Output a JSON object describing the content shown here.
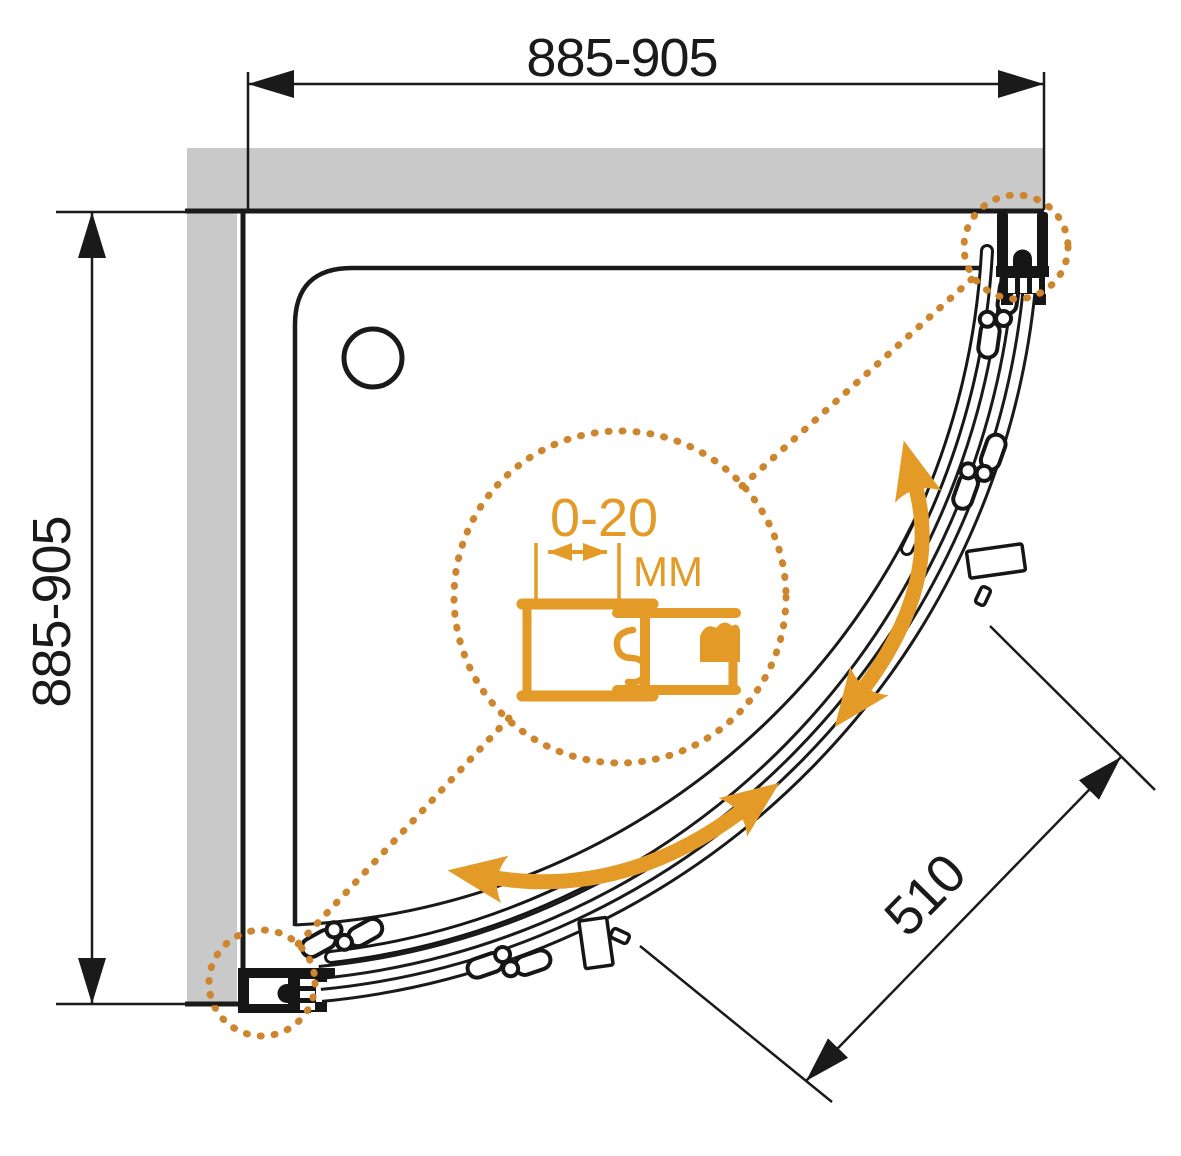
{
  "meta": {
    "title": "Quadrant shower enclosure - top view installation drawing",
    "view": "plan"
  },
  "dims": {
    "width": "885-905",
    "height": "885-905",
    "entry": "510"
  },
  "detail": {
    "range": "0-20",
    "unit": "MM"
  },
  "colors": {
    "accent": "#E39A26",
    "dots": "#CE862E",
    "wall": "#C9C9C9",
    "ink": "#1A1A1A"
  },
  "parts": [
    "top-wall",
    "left-wall",
    "shower-tray",
    "drain",
    "curved-track-rails",
    "sliding-door-upper",
    "sliding-door-lower",
    "roller-carriages",
    "door-handles",
    "wall-profile-top-right",
    "wall-profile-bottom-left",
    "adjustment-detail-callout",
    "door-swing-arrows"
  ]
}
